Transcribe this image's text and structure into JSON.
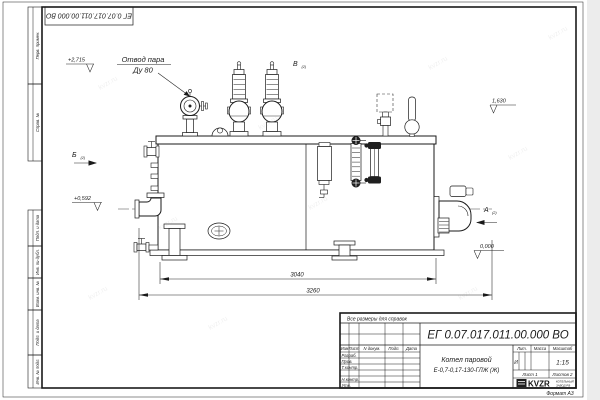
{
  "sheet": {
    "stamp_doc_number": "ЕГ 0.07.017.011.00.000 ВО",
    "margin_cells": {
      "c1": "Перв. примен.",
      "c2": "Справ. №",
      "c3": "Подп. и дата",
      "c4": "Инв. № дубл.",
      "c5": "Взам. инв. №",
      "c6": "Подп. и дата",
      "c7": "Инв. № подл."
    },
    "watermark": "kvzr.ru"
  },
  "callout": {
    "line1": "Отвод пара",
    "line2": "Ду 80"
  },
  "views": {
    "a": "А",
    "b": "Б",
    "v": "В",
    "sheet_ref": "(2)"
  },
  "elevations": {
    "top": "+2,715",
    "right": "1,630",
    "left": "+0,592",
    "zero": "0,000"
  },
  "dimensions": {
    "inner": "3040",
    "overall": "3260"
  },
  "title_block": {
    "note": "Все размеры для справок",
    "doc_number": "ЕГ 0.07.017.011.00.000 ВО",
    "name_line1": "Котел паровой",
    "name_line2": "Е-0,7-0,17-130-ГЛЖ (Ж)",
    "col_izm": "Изм",
    "col_list": "Лист",
    "col_doc": "N докум.",
    "col_podp": "Подп.",
    "col_data": "Дата",
    "row_razrab": "Разраб.",
    "row_prov": "Пров.",
    "row_tkontr": "Т.контр.",
    "row_nkontr": "Н.контр.",
    "row_utv": "Утв.",
    "lit_header": "Лит.",
    "lit_value": "И",
    "mass_header": "Масса",
    "scale_header": "Масштаб",
    "scale_value": "1:15",
    "sheet_no": "Лист 1",
    "sheets_total": "Листов 2",
    "logo_text": "KVZR",
    "brand_line1": "КОТЕЛЬНЫЙ",
    "brand_line2": "ЗАВОД РФ",
    "format_label": "Формат А3"
  }
}
